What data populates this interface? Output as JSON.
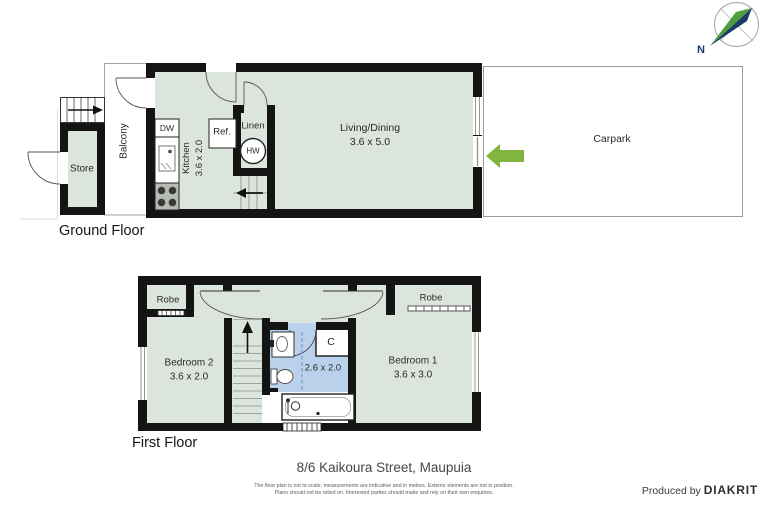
{
  "compass": {
    "north_label": "N"
  },
  "ground_floor": {
    "label": "Ground Floor",
    "store_label": "Store",
    "balcony_label": "Balcony",
    "dishwasher_label": "DW",
    "kitchen": {
      "name": "Kitchen",
      "dims": "3.6 x 2.0"
    },
    "fridge_label": "Ref.",
    "linen_label": "Linen",
    "hot_water_label": "HW",
    "living": {
      "name": "Living/Dining",
      "dims": "3.6 x 5.0"
    },
    "carpark_label": "Carpark"
  },
  "first_floor": {
    "label": "First Floor",
    "robe_left_label": "Robe",
    "robe_right_label": "Robe",
    "bedroom2": {
      "name": "Bedroom 2",
      "dims": "3.6 x 2.0"
    },
    "bathroom": {
      "dims": "2.6 x 2.0"
    },
    "cupboard_label": "C",
    "bedroom1": {
      "name": "Bedroom 1",
      "dims": "3.6 x 3.0"
    }
  },
  "footer": {
    "title": "8/6 Kaikoura Street, Maupuia",
    "disclaimer_line1": "The floor plan is not to scale, measurements are indicative and in metres. Exterior elements are not in position.",
    "disclaimer_line2": "Plans should not be relied on. Interested parties should make and rely on their own enquiries.",
    "produced_by": "Produced by",
    "brand": "DIAKRIT"
  },
  "colors": {
    "room_fill": "#dce5dc",
    "wet_area_fill": "#b9d1ea",
    "wall": "#141414",
    "entry_arrow_green": "#82b440",
    "compass_green": "#4f9e3e",
    "compass_navy": "#1b3a66"
  }
}
